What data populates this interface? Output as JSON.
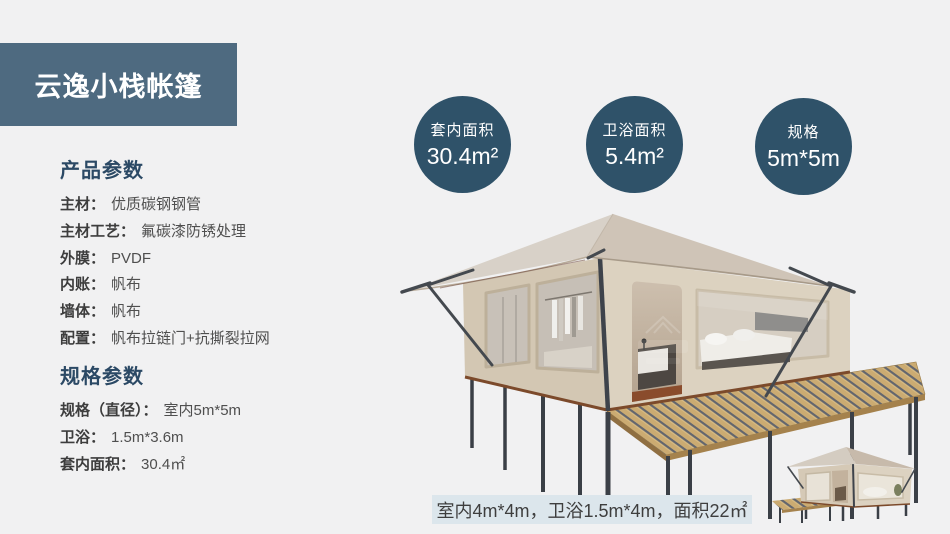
{
  "slide": {
    "title": "云逸小栈帐篷"
  },
  "stats": [
    {
      "label": "套内面积",
      "value": "30.4m²"
    },
    {
      "label": "卫浴面积",
      "value": "5.4m²"
    },
    {
      "label": "规格",
      "value": "5m*5m"
    }
  ],
  "product_params": {
    "header": "产品参数",
    "rows": [
      {
        "label": "主材：",
        "value": "优质碳钢钢管"
      },
      {
        "label": "主材工艺：",
        "value": "氟碳漆防锈处理"
      },
      {
        "label": "外膜：",
        "value": "PVDF"
      },
      {
        "label": "内账：",
        "value": "帆布"
      },
      {
        "label": "墙体：",
        "value": "帆布"
      },
      {
        "label": "配置：",
        "value": "帆布拉链门+抗撕裂拉网"
      }
    ]
  },
  "spec_params": {
    "header": "规格参数",
    "rows": [
      {
        "label": "规格（直径）：",
        "value": "室内5m*5m"
      },
      {
        "label": "卫浴：",
        "value": "1.5m*3.6m"
      },
      {
        "label": "套内面积：",
        "value": "30.4㎡"
      }
    ]
  },
  "caption": {
    "text": "室内4m*4m，卫浴1.5m*4m，面积22㎡"
  },
  "illustrations": {
    "main_tent": "glamping-tent-3d-render-with-wood-deck",
    "small_tent": "small-glamping-tent-3d-render"
  },
  "colors": {
    "background": "#f1f1f2",
    "banner_bg": "#4e6a80",
    "circle_bg": "#2f5269",
    "heading_text": "#2b4965",
    "caption_bg": "#dce6ec",
    "tent_canvas": "#d6cbb8",
    "tent_roof": "#d3cabf",
    "deck_wood": "#c9a96d",
    "frame_metal": "#44494f"
  }
}
